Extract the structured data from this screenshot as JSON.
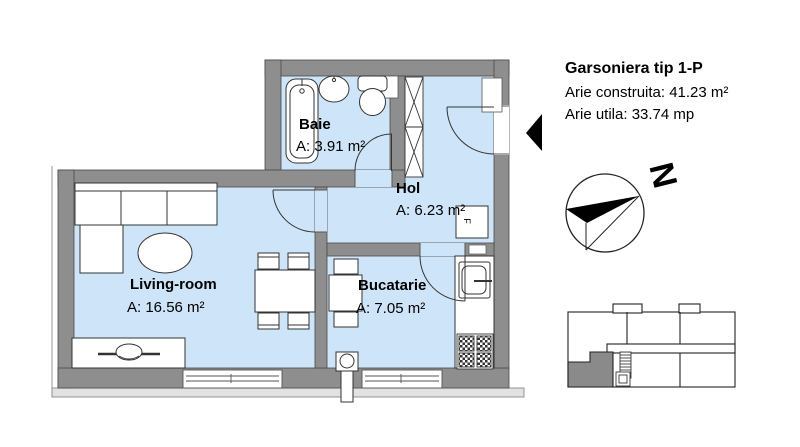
{
  "info_panel": {
    "title": "Garsoniera tip 1-P",
    "built_area": "Arie construita: 41.23 m²",
    "usable_area": "Arie utila: 33.74 mp"
  },
  "rooms": {
    "baie": {
      "name": "Baie",
      "area": "A: 3.91 m²"
    },
    "hol": {
      "name": "Hol",
      "area": "A: 6.23 m²"
    },
    "living": {
      "name": "Living-room",
      "area": "A: 16.56 m²"
    },
    "bucatarie": {
      "name": "Bucatarie",
      "area": "A: 7.05 m²"
    }
  },
  "compass": {
    "north_label": "N"
  },
  "annotations": {
    "furnace_label": "F"
  },
  "colors": {
    "floor_fill": "#cee4f8",
    "wall_fill": "#8e8e8e",
    "outline": "#3a3a3a",
    "accent": "#000000"
  }
}
